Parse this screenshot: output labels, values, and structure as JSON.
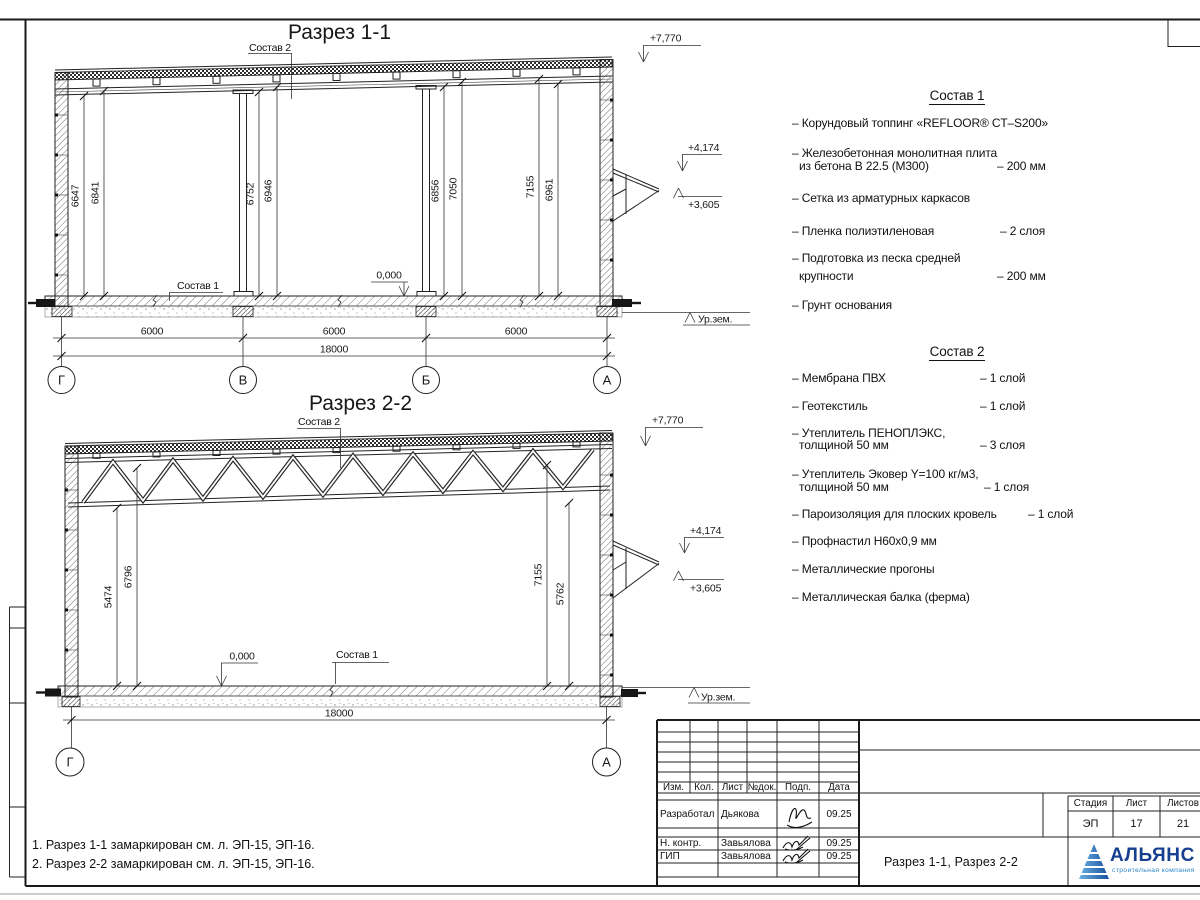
{
  "sections": {
    "s1": {
      "title": "Разрез 1-1",
      "sostav1_label": "Состав 1",
      "sostav2_label": "Состав 2",
      "elev_roof": "+7,770",
      "elev_canopy": "+4,174",
      "elev_tip": "+3,605",
      "elev_zero": "0,000",
      "ground": "Ур.зем.",
      "vdims": [
        "6647",
        "6841",
        "6752",
        "6946",
        "6856",
        "7050",
        "7155",
        "6961"
      ],
      "spans": [
        "6000",
        "6000",
        "6000"
      ],
      "total": "18000",
      "axes": [
        "Г",
        "В",
        "Б",
        "А"
      ]
    },
    "s2": {
      "title": "Разрез 2-2",
      "sostav1_label": "Состав 1",
      "sostav2_label": "Состав 2",
      "elev_roof": "+7,770",
      "elev_canopy": "+4,174",
      "elev_tip": "+3,605",
      "elev_zero": "0,000",
      "ground": "Ур.зем.",
      "vdims": [
        "5474",
        "6796",
        "7155",
        "5762"
      ],
      "total": "18000",
      "axes": [
        "Г",
        "А"
      ]
    }
  },
  "sostav1": {
    "title": "Состав 1",
    "rows": [
      {
        "left": "– Корундовый топпинг «REFLOOR® CT–S200»",
        "right": ""
      },
      {
        "left": "– Железобетонная  монолитная плита",
        "right": ""
      },
      {
        "left": "из бетона В 22.5 (М300)",
        "right": "– 200 мм"
      },
      {
        "left": "– Сетка из арматурных каркасов",
        "right": ""
      },
      {
        "left": "– Пленка полиэтиленовая",
        "right": "– 2 слоя"
      },
      {
        "left": "– Подготовка из песка средней",
        "right": ""
      },
      {
        "left": "крупности",
        "right": "– 200 мм"
      },
      {
        "left": "– Грунт основания",
        "right": ""
      }
    ]
  },
  "sostav2": {
    "title": "Состав 2",
    "rows": [
      {
        "left": "– Мембрана ПВХ",
        "right": "– 1 слой"
      },
      {
        "left": "– Геотекстиль",
        "right": "– 1 слой"
      },
      {
        "left": "– Утеплитель ПЕНОПЛЭКС,",
        "right": ""
      },
      {
        "left": "толщиной 50 мм",
        "right": "– 3 слоя"
      },
      {
        "left": "– Утеплитель Эковер Y=100 кг/м3,",
        "right": ""
      },
      {
        "left": "толщиной 50 мм",
        "right": "– 1 слоя"
      },
      {
        "left": "– Пароизоляция для плоских кровель",
        "right": "– 1 слой"
      },
      {
        "left": "– Профнастил Н60х0,9 мм",
        "right": ""
      },
      {
        "left": "– Металлические прогоны",
        "right": ""
      },
      {
        "left": "– Металлическая балка (ферма)",
        "right": ""
      }
    ]
  },
  "notes": {
    "line1": "1. Разрез 1-1 замаркирован см. л. ЭП-15, ЭП-16.",
    "line2": "2. Разрез 2-2 замаркирован см. л. ЭП-15, ЭП-16."
  },
  "titleblock": {
    "cols": {
      "izm": "Изм.",
      "kol": "Кол.",
      "list": "Лист",
      "doc": "№док.",
      "sign": "Подп.",
      "date": "Дата"
    },
    "r1": {
      "role": "Разработал",
      "name": "Дьякова",
      "date": "09.25"
    },
    "r2": {
      "role": "Н. контр.",
      "name": "Завьялова",
      "date": "09.25"
    },
    "r3": {
      "role": "ГИП",
      "name": "Завьялова",
      "date": "09.25"
    },
    "doc_title": "Разрез 1-1, Разрез 2-2",
    "stage_label": "Стадия",
    "sheet_label": "Лист",
    "sheets_label": "Листов",
    "stage": "ЭП",
    "sheet_no": "17",
    "sheets_total": "21",
    "logo_name": "АЛЬЯНС",
    "logo_sub": "строительная компания",
    "logo_blue": "#1d6fc0",
    "logo_navy": "#163f8f"
  }
}
